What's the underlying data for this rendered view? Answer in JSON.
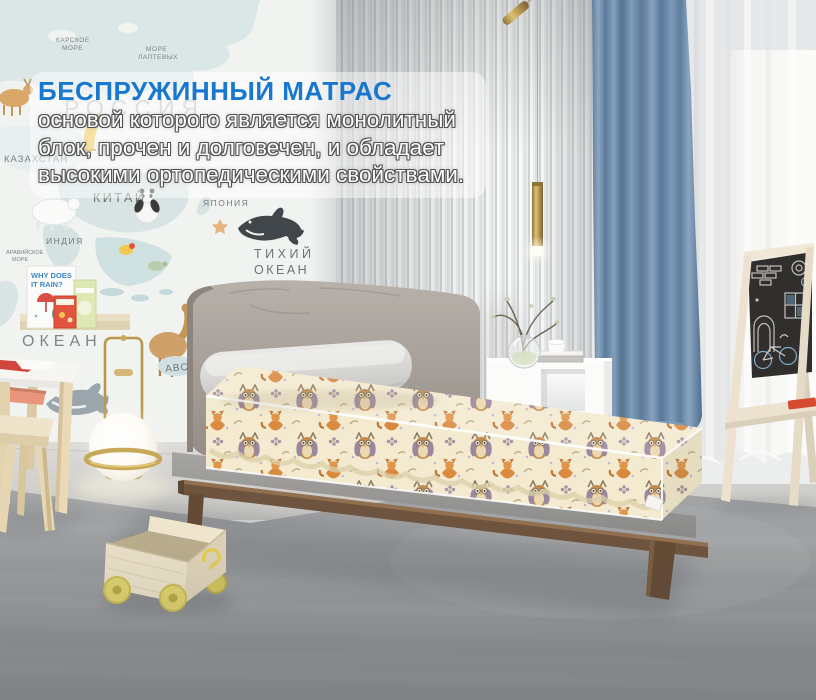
{
  "overlay": {
    "title": "БЕСПРУЖИННЫЙ МАТРАС",
    "line1": "основой которого является монолитный",
    "line2": "блок, прочен и долговечен, и обладает",
    "line3": "высокими ортопедическими свойствами.",
    "title_color": "#1878cf"
  },
  "map": {
    "russia": "РОССИЯ",
    "kazakhstan": "КАЗАХСТАН",
    "china": "КИТАЙ",
    "japan": "ЯПОНИЯ",
    "india": "ИНДИЯ",
    "pacific1": "ТИХИЙ",
    "pacific2": "ОКЕАН",
    "kara1": "КАРСКОЕ",
    "kara2": "МОРЕ",
    "laptev1": "МОРЕ",
    "laptev2": "ЛАПТЕВЫХ",
    "arab1": "АРАВИЙСКОЕ",
    "arab2": "МОРЕ",
    "ocean_big": "ОКЕАН",
    "abc": "ABC",
    "book_line1": "WHY DOES",
    "book_line2": "IT RAIN?"
  },
  "palette": {
    "title_blue": "#1878cf",
    "curtain_blue": "#6c8cab",
    "mattress_cream": "#f2e9cf",
    "headboard_gray": "#a7a19a",
    "wood_walnut": "#6e543e",
    "brass_gold": "#b99a4f",
    "floor_gray": "#9c9ea0",
    "chalkboard_dark": "#302f2e",
    "cart_wheel_yellow": "#dcd06c",
    "table_coral": "#e8957c"
  }
}
